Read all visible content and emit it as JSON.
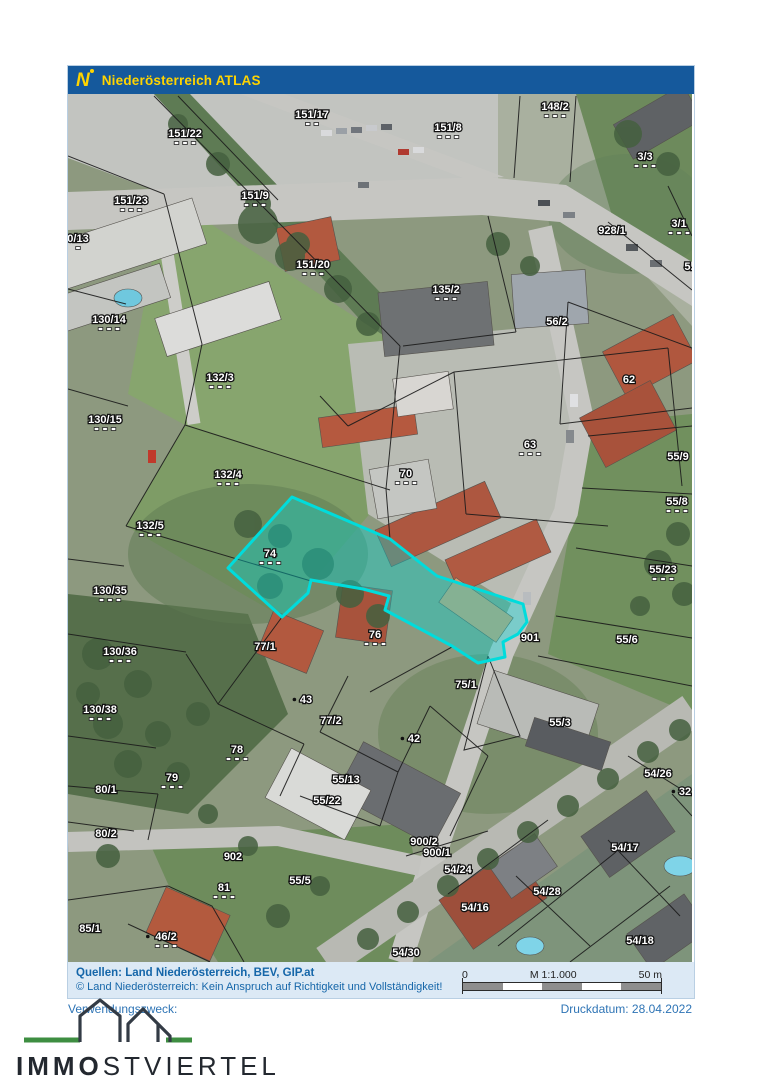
{
  "header": {
    "logo_letter": "N",
    "title": "Niederösterreich ATLAS"
  },
  "colors": {
    "header_bg": "#15599c",
    "accent_yellow": "#ffd400",
    "footer_bg": "#dce9f5",
    "footer_text": "#1566a9",
    "highlight_stroke": "#00dcdc",
    "highlight_fill": "rgba(0,216,216,0.38)",
    "brand_green": "#3e8e41",
    "brand_dark": "#23282f"
  },
  "map": {
    "highlight_polygon": [
      [
        160,
        474
      ],
      [
        224,
        403
      ],
      [
        322,
        445
      ],
      [
        369,
        482
      ],
      [
        455,
        510
      ],
      [
        459,
        528
      ],
      [
        450,
        540
      ],
      [
        435,
        548
      ],
      [
        437,
        563
      ],
      [
        410,
        569
      ],
      [
        384,
        552
      ],
      [
        317,
        516
      ],
      [
        321,
        502
      ],
      [
        295,
        495
      ],
      [
        243,
        486
      ],
      [
        240,
        499
      ],
      [
        214,
        523
      ]
    ],
    "labels": [
      {
        "t": "151/22",
        "x": 117,
        "y": 43,
        "d": 3
      },
      {
        "t": "151/17",
        "x": 244,
        "y": 24,
        "d": 2
      },
      {
        "t": "148/2",
        "x": 487,
        "y": 16,
        "d": 3
      },
      {
        "t": "151/8",
        "x": 380,
        "y": 37,
        "d": 3
      },
      {
        "t": "3/3",
        "x": 577,
        "y": 66,
        "d": 3
      },
      {
        "t": "151/23",
        "x": 63,
        "y": 110,
        "d": 3
      },
      {
        "t": "151/9",
        "x": 187,
        "y": 105,
        "d": 3
      },
      {
        "t": "928/1",
        "x": 544,
        "y": 140,
        "d": 0
      },
      {
        "t": "3/1",
        "x": 611,
        "y": 133,
        "d": 3
      },
      {
        "t": "5.",
        "x": 621,
        "y": 176,
        "d": 0
      },
      {
        "t": "0/13",
        "x": 10,
        "y": 148,
        "d": 1
      },
      {
        "t": "151/20",
        "x": 245,
        "y": 174,
        "d": 3
      },
      {
        "t": "135/2",
        "x": 378,
        "y": 199,
        "d": 3
      },
      {
        "t": "56/2",
        "x": 489,
        "y": 231,
        "d": 0
      },
      {
        "t": "130/14",
        "x": 41,
        "y": 229,
        "d": 3
      },
      {
        "t": "62",
        "x": 561,
        "y": 289,
        "d": 0
      },
      {
        "t": "132/3",
        "x": 152,
        "y": 287,
        "d": 3
      },
      {
        "t": "130/15",
        "x": 37,
        "y": 329,
        "d": 3
      },
      {
        "t": "63",
        "x": 462,
        "y": 354,
        "d": 3
      },
      {
        "t": "70",
        "x": 338,
        "y": 383,
        "d": 3
      },
      {
        "t": "132/4",
        "x": 160,
        "y": 384,
        "d": 3
      },
      {
        "t": "55/9",
        "x": 610,
        "y": 366,
        "d": 0
      },
      {
        "t": "55/8",
        "x": 609,
        "y": 411,
        "d": 3
      },
      {
        "t": "132/5",
        "x": 82,
        "y": 435,
        "d": 3
      },
      {
        "t": "74",
        "x": 202,
        "y": 463,
        "d": 3
      },
      {
        "t": "55/23",
        "x": 595,
        "y": 479,
        "d": 3
      },
      {
        "t": "130/35",
        "x": 42,
        "y": 500,
        "d": 3
      },
      {
        "t": "901",
        "x": 462,
        "y": 547,
        "d": 0
      },
      {
        "t": "55/6",
        "x": 559,
        "y": 549,
        "d": 0
      },
      {
        "t": "76",
        "x": 307,
        "y": 544,
        "d": 3
      },
      {
        "t": "77/1",
        "x": 197,
        "y": 556,
        "d": 0
      },
      {
        "t": "130/36",
        "x": 52,
        "y": 561,
        "d": 3
      },
      {
        "t": "75/1",
        "x": 398,
        "y": 594,
        "d": 0
      },
      {
        "t": "43",
        "x": 238,
        "y": 609,
        "d": 0,
        "p": 1
      },
      {
        "t": "130/38",
        "x": 32,
        "y": 619,
        "d": 3
      },
      {
        "t": "77/2",
        "x": 263,
        "y": 630,
        "d": 0
      },
      {
        "t": "55/3",
        "x": 492,
        "y": 632,
        "d": 0
      },
      {
        "t": "42",
        "x": 346,
        "y": 648,
        "d": 0,
        "p": 1
      },
      {
        "t": "78",
        "x": 169,
        "y": 659,
        "d": 3
      },
      {
        "t": "54/26",
        "x": 590,
        "y": 683,
        "d": 0
      },
      {
        "t": "55/13",
        "x": 278,
        "y": 689,
        "d": 0
      },
      {
        "t": "79",
        "x": 104,
        "y": 687,
        "d": 3
      },
      {
        "t": "32",
        "x": 617,
        "y": 701,
        "d": 0,
        "p": 1
      },
      {
        "t": "80/1",
        "x": 38,
        "y": 699,
        "d": 0
      },
      {
        "t": "55/22",
        "x": 259,
        "y": 710,
        "d": 0
      },
      {
        "t": "80/2",
        "x": 38,
        "y": 743,
        "d": 0
      },
      {
        "t": "900/2",
        "x": 356,
        "y": 751,
        "d": 0
      },
      {
        "t": "900/1",
        "x": 369,
        "y": 762,
        "d": 0
      },
      {
        "t": "902",
        "x": 165,
        "y": 766,
        "d": 0
      },
      {
        "t": "54/17",
        "x": 557,
        "y": 757,
        "d": 0
      },
      {
        "t": "54/24",
        "x": 390,
        "y": 779,
        "d": 0
      },
      {
        "t": "81",
        "x": 156,
        "y": 797,
        "d": 3
      },
      {
        "t": "55/5",
        "x": 232,
        "y": 790,
        "d": 0
      },
      {
        "t": "54/28",
        "x": 479,
        "y": 801,
        "d": 0
      },
      {
        "t": "54/16",
        "x": 407,
        "y": 817,
        "d": 0
      },
      {
        "t": "85/1",
        "x": 22,
        "y": 838,
        "d": 0
      },
      {
        "t": "46/2",
        "x": 98,
        "y": 846,
        "d": 3,
        "p": 1
      },
      {
        "t": "54/18",
        "x": 572,
        "y": 850,
        "d": 0
      },
      {
        "t": "54/30",
        "x": 338,
        "y": 862,
        "d": 0
      }
    ]
  },
  "footer": {
    "sources": "Quellen:  Land Niederösterreich,  BEV,  GIP.at",
    "disclaimer": "© Land Niederösterreich: Kein Anspruch auf Richtigkeit und Vollständigkeit!",
    "scalebar": {
      "zero": "0",
      "scale": "M 1:1.000",
      "max": "50 m"
    }
  },
  "meta": {
    "purpose": "Verwendungszweck:",
    "print_date": "Druckdatum: 28.04.2022"
  },
  "brand": {
    "bold": "IMMO",
    "light": "STVIERTEL"
  }
}
